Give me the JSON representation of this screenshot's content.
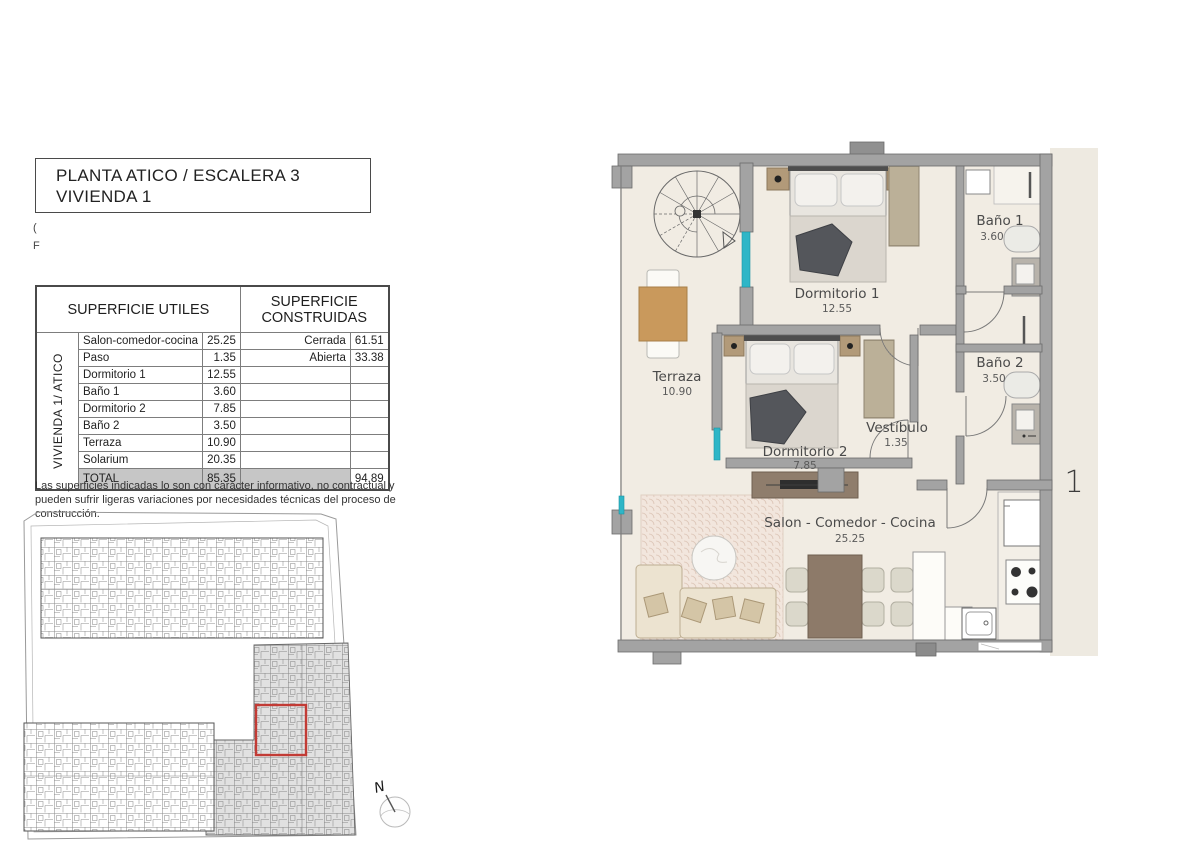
{
  "title_block": {
    "line1": "PLANTA ATICO / ESCALERA 3",
    "line2": "VIVIENDA 1"
  },
  "margin_fragments": {
    "top": "(",
    "bottom": "F"
  },
  "surface_table": {
    "header_utiles": "SUPERFICIE UTILES",
    "header_construidas": "SUPERFICIE CONSTRUIDAS",
    "vertical_label": "VIVIENDA 1/ ATICO",
    "rows": [
      {
        "name": "Salon-comedor-cocina",
        "m2": "25.25",
        "cons_name": "Cerrada",
        "cons_m2": "61.51"
      },
      {
        "name": "Paso",
        "m2": "1.35",
        "cons_name": "Abierta",
        "cons_m2": "33.38"
      },
      {
        "name": "Dormitorio 1",
        "m2": "12.55",
        "cons_name": "",
        "cons_m2": ""
      },
      {
        "name": "Baño 1",
        "m2": "3.60",
        "cons_name": "",
        "cons_m2": ""
      },
      {
        "name": "Dormitorio 2",
        "m2": "7.85",
        "cons_name": "",
        "cons_m2": ""
      },
      {
        "name": "Baño 2",
        "m2": "3.50",
        "cons_name": "",
        "cons_m2": ""
      },
      {
        "name": "Terraza",
        "m2": "10.90",
        "cons_name": "",
        "cons_m2": ""
      },
      {
        "name": "Solarium",
        "m2": "20.35",
        "cons_name": "",
        "cons_m2": ""
      }
    ],
    "total_label": "TOTAL",
    "total_utiles": "85.35",
    "total_construidas": "94.89"
  },
  "disclaimer": "Las superficies indicadas lo son con carácter informativo, no contractual y pueden sufrir ligeras variaciones por necesidades técnicas del proceso de construcción.",
  "floorplan": {
    "unit_number": "1",
    "rooms": {
      "terraza": {
        "name": "Terraza",
        "m2": "10.90"
      },
      "dormitorio1": {
        "name": "Dormitorio 1",
        "m2": "12.55"
      },
      "dormitorio2": {
        "name": "Dormitorio 2",
        "m2": "7.85"
      },
      "bano1": {
        "name": "Baño 1",
        "m2": "3.60"
      },
      "bano2": {
        "name": "Baño 2",
        "m2": "3.50"
      },
      "vestibulo": {
        "name": "Vestíbulo",
        "m2": "1.35"
      },
      "salon": {
        "name": "Salon - Comedor - Cocina",
        "m2": "25.25"
      }
    }
  },
  "site_plan": {
    "north_label": "N"
  },
  "colors": {
    "wall_gray": "#a3a3a3",
    "floor_beige": "#f1ece3",
    "accent_teal": "#2eb6c7",
    "highlight_red": "#c23b35",
    "total_row_gray": "#c6c6c6"
  }
}
